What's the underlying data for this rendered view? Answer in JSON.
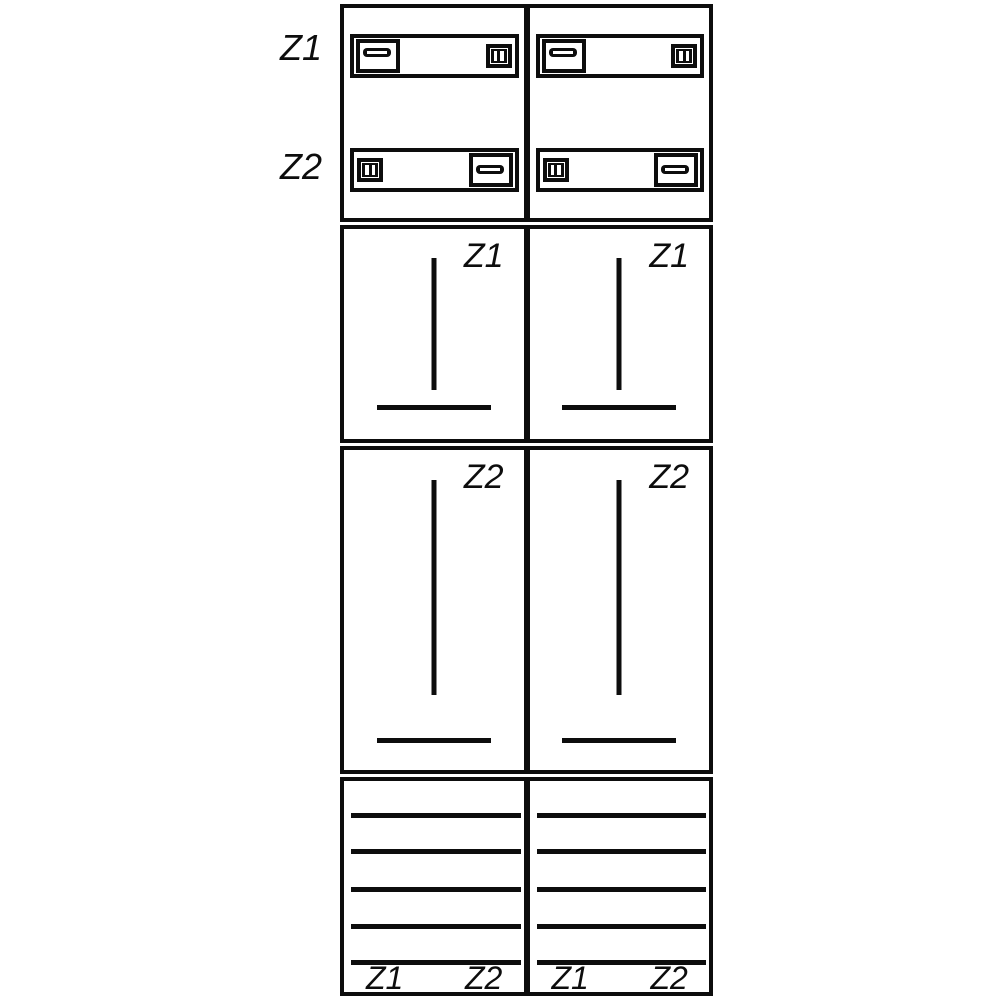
{
  "colors": {
    "ink": "#0d0d0d",
    "paper": "#ffffff"
  },
  "side_labels": {
    "z1": "Z1",
    "z2": "Z2"
  },
  "columns": [
    {
      "z1_section_label": "Z1",
      "z2_section_label": "Z2",
      "reserve": {
        "z1": "Z1",
        "z2": "Z2"
      }
    },
    {
      "z1_section_label": "Z1",
      "z2_section_label": "Z2",
      "reserve": {
        "z1": "Z1",
        "z2": "Z2"
      }
    }
  ]
}
